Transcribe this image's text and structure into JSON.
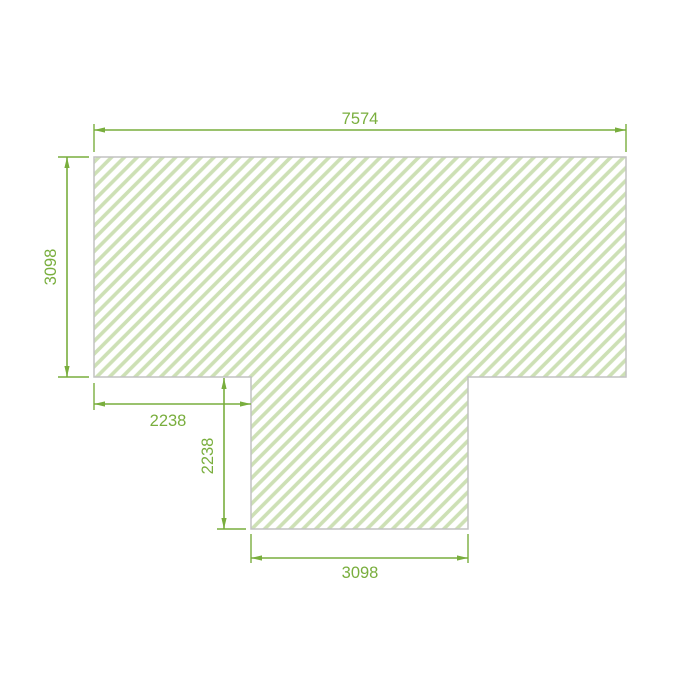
{
  "drawing": {
    "type": "dimensioned-floor-plan",
    "shape_description": "T-shaped hatched region: wide bar on top with a centered-left stem extending downward",
    "colors": {
      "dimension_green": "#79ae3d",
      "hatch_green": "#cde0b5",
      "outline_gray": "#c2c2c2",
      "background": "#ffffff"
    },
    "dimensions": {
      "overall_width": "7574",
      "left_height": "3098",
      "stem_left_offset": "2238",
      "stem_height": "2238",
      "stem_width": "3098"
    }
  }
}
